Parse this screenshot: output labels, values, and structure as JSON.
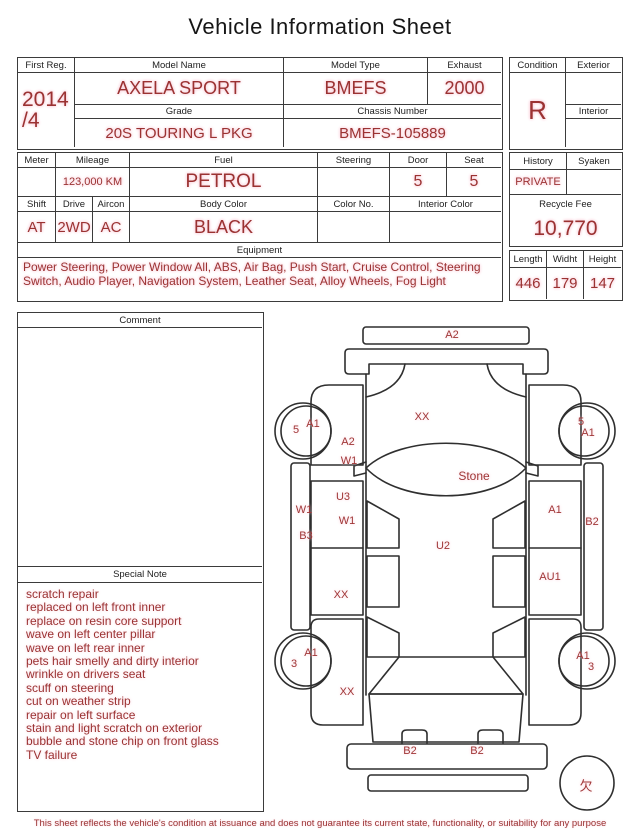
{
  "title": "Vehicle Information Sheet",
  "main": {
    "first_reg": {
      "label": "First Reg.",
      "line1": "2014",
      "line2": "/4"
    },
    "model_name": {
      "label": "Model Name",
      "value": "AXELA SPORT"
    },
    "grade": {
      "label": "Grade",
      "value": "20S TOURING L PKG"
    },
    "model_type": {
      "label": "Model Type",
      "value": "BMEFS"
    },
    "exhaust": {
      "label": "Exhaust",
      "value": "2000"
    },
    "chassis": {
      "label": "Chassis Number",
      "value": "BMEFS-105889"
    }
  },
  "condition": {
    "label": "Condition",
    "value": "R",
    "exterior_label": "Exterior",
    "exterior_value": "",
    "interior_label": "Interior",
    "interior_value": ""
  },
  "specs": {
    "meter": {
      "label": "Meter",
      "value": ""
    },
    "mileage": {
      "label": "Mileage",
      "value": "123,000 KM"
    },
    "fuel": {
      "label": "Fuel",
      "value": "PETROL"
    },
    "steering": {
      "label": "Steering",
      "value": ""
    },
    "door": {
      "label": "Door",
      "value": "5"
    },
    "seat": {
      "label": "Seat",
      "value": "5"
    },
    "shift": {
      "label": "Shift",
      "value": "AT"
    },
    "drive": {
      "label": "Drive",
      "value": "2WD"
    },
    "aircon": {
      "label": "Aircon",
      "value": "AC"
    },
    "body_color": {
      "label": "Body Color",
      "value": "BLACK"
    },
    "color_no": {
      "label": "Color No.",
      "value": ""
    },
    "interior_color": {
      "label": "Interior Color",
      "value": ""
    }
  },
  "history": {
    "label": "History",
    "value": "PRIVATE",
    "syaken_label": "Syaken",
    "syaken_value": "",
    "recycle_label": "Recycle Fee",
    "recycle_value": "10,770"
  },
  "dimensions": {
    "length_label": "Length",
    "length": "446",
    "width_label": "Widht",
    "width": "179",
    "height_label": "Height",
    "height": "147"
  },
  "equipment": {
    "label": "Equipment",
    "text": "Power Steering, Power Window  All, ABS, Air Bag, Push Start, Cruise Control, Steering Switch, Audio Player, Navigation System, Leather Seat, Alloy Wheels, Fog Light"
  },
  "comment": {
    "label": "Comment",
    "text": ""
  },
  "special_note": {
    "label": "Special Note",
    "lines": [
      "scratch repair",
      "replaced on left front inner",
      "replace on resin core support",
      "wave on left center pillar",
      "wave on left rear inner",
      "pets hair smelly and dirty interior",
      "wrinkle on drivers seat",
      "scuff on steering",
      "cut on weather strip",
      "repair on left surface",
      "stain and light scratch on exterior",
      "bubble and stone chip on front glass",
      "TV failure"
    ]
  },
  "diagram": {
    "labels": [
      {
        "text": "A2",
        "x": 187,
        "y": 30
      },
      {
        "text": "XX",
        "x": 157,
        "y": 112
      },
      {
        "text": "5",
        "x": 31,
        "y": 125
      },
      {
        "text": "A1",
        "x": 48,
        "y": 119
      },
      {
        "text": "5",
        "x": 316,
        "y": 117
      },
      {
        "text": "A1",
        "x": 323,
        "y": 128
      },
      {
        "text": "A2",
        "x": 83,
        "y": 137
      },
      {
        "text": "W1",
        "x": 84,
        "y": 156
      },
      {
        "text": "Stone",
        "x": 209,
        "y": 171,
        "size": 12
      },
      {
        "text": "W1",
        "x": 39,
        "y": 205
      },
      {
        "text": "B3",
        "x": 41,
        "y": 231
      },
      {
        "text": "U3",
        "x": 78,
        "y": 192
      },
      {
        "text": "W1",
        "x": 82,
        "y": 216
      },
      {
        "text": "A1",
        "x": 290,
        "y": 205
      },
      {
        "text": "B2",
        "x": 327,
        "y": 217
      },
      {
        "text": "U2",
        "x": 178,
        "y": 241
      },
      {
        "text": "AU1",
        "x": 285,
        "y": 272
      },
      {
        "text": "XX",
        "x": 76,
        "y": 290
      },
      {
        "text": "A1",
        "x": 46,
        "y": 348
      },
      {
        "text": "3",
        "x": 29,
        "y": 359
      },
      {
        "text": "A1",
        "x": 318,
        "y": 351
      },
      {
        "text": "3",
        "x": 326,
        "y": 362
      },
      {
        "text": "XX",
        "x": 82,
        "y": 387
      },
      {
        "text": "B2",
        "x": 145,
        "y": 446
      },
      {
        "text": "B2",
        "x": 212,
        "y": 446
      },
      {
        "text": "欠",
        "x": 321,
        "y": 480,
        "size": 13
      }
    ]
  },
  "footer": {
    "disclaimer": "This sheet reflects the vehicle's condition at issuance and does not guarantee its current state, functionality, or suitability for any purpose"
  },
  "colors": {
    "accent_red": "#9b3232",
    "halo_pink": "#f9cdd9",
    "ink": "#1e1e1e",
    "line": "#3b3b3b"
  }
}
